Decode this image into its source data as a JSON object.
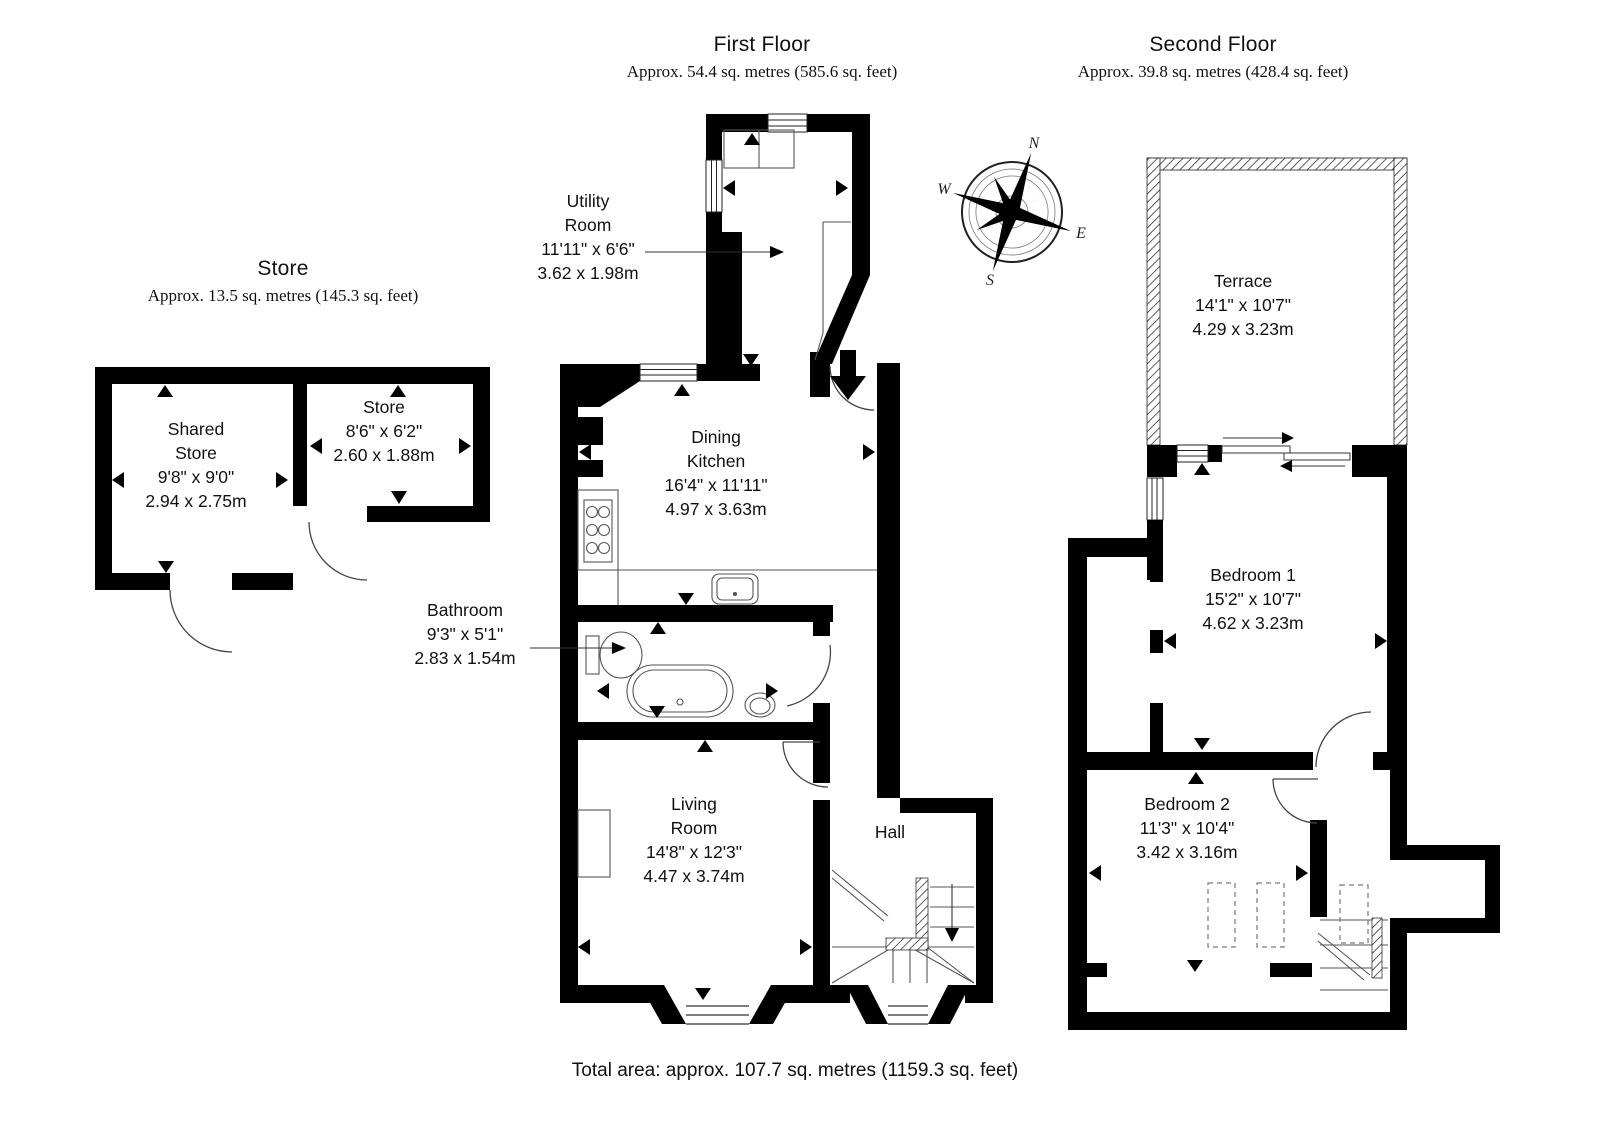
{
  "headers": {
    "store": {
      "title": "Store",
      "area": "Approx. 13.5 sq. metres (145.3 sq. feet)"
    },
    "first_floor": {
      "title": "First Floor",
      "area": "Approx. 54.4 sq. metres (585.6 sq. feet)"
    },
    "second_floor": {
      "title": "Second Floor",
      "area": "Approx. 39.8 sq. metres (428.4 sq. feet)"
    }
  },
  "rooms": {
    "shared_store": {
      "name": "Shared\nStore",
      "imperial": "9'8\" x 9'0\"",
      "metric": "2.94 x 2.75m"
    },
    "store": {
      "name": "Store",
      "imperial": "8'6\" x 6'2\"",
      "metric": "2.60 x 1.88m"
    },
    "utility": {
      "name": "Utility\nRoom",
      "imperial": "11'11\" x 6'6\"",
      "metric": "3.62 x 1.98m"
    },
    "dining_kitchen": {
      "name": "Dining\nKitchen",
      "imperial": "16'4\" x 11'11\"",
      "metric": "4.97 x 3.63m"
    },
    "bathroom": {
      "name": "Bathroom",
      "imperial": "9'3\" x 5'1\"",
      "metric": "2.83 x 1.54m"
    },
    "living_room": {
      "name": "Living\nRoom",
      "imperial": "14'8\" x 12'3\"",
      "metric": "4.47 x 3.74m"
    },
    "hall": {
      "name": "Hall"
    },
    "terrace": {
      "name": "Terrace",
      "imperial": "14'1\" x 10'7\"",
      "metric": "4.29 x 3.23m"
    },
    "bedroom1": {
      "name": "Bedroom 1",
      "imperial": "15'2\" x 10'7\"",
      "metric": "4.62 x 3.23m"
    },
    "bedroom2": {
      "name": "Bedroom 2",
      "imperial": "11'3\" x 10'4\"",
      "metric": "3.42 x 3.16m"
    }
  },
  "compass": {
    "north": "N",
    "east": "E",
    "south": "S",
    "west": "W"
  },
  "footer": {
    "total_area": "Total area: approx. 107.7 sq. metres (1159.3 sq. feet)"
  },
  "colors": {
    "wall": "#000000",
    "line": "#444444"
  }
}
